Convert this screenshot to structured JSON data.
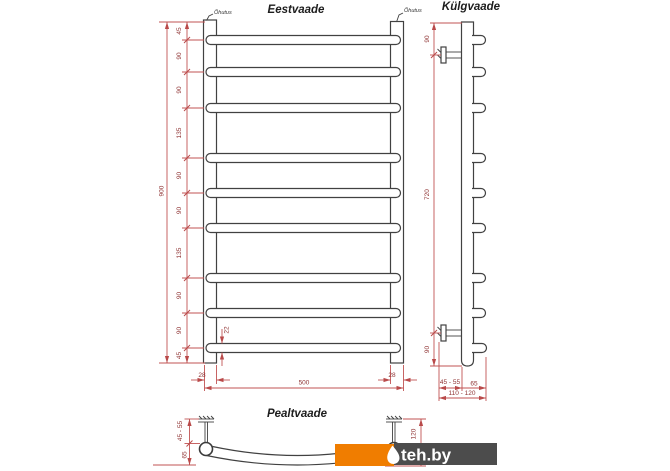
{
  "views": {
    "front": {
      "title": "Eestvaade",
      "vent_label_left": "Õhutus",
      "vent_label_right": "Õhutus",
      "overall_height": "900",
      "height_segments": [
        "45",
        "90",
        "90",
        "135",
        "90",
        "90",
        "135",
        "90",
        "90",
        "45"
      ],
      "rung_diameter": "22",
      "stub_left": "28",
      "stub_right": "28",
      "width": "500"
    },
    "side": {
      "title": "Külgvaade",
      "top_offset": "90",
      "bracket_span": "720",
      "bottom_offset": "90",
      "wall_gap": "45 - 55",
      "body_depth": "65",
      "total_depth": "110 - 120"
    },
    "top": {
      "title": "Pealtvaade",
      "wall_gap": "45 - 55",
      "curve_depth": "65",
      "total_depth": "120"
    }
  },
  "watermark": {
    "text": "teh.by",
    "orange": "#F07D00",
    "gray": "#4C4C4C"
  },
  "colors": {
    "drawing_line": "#414141",
    "dimension_line": "#C15353",
    "dimension_text": "#8F3333"
  }
}
